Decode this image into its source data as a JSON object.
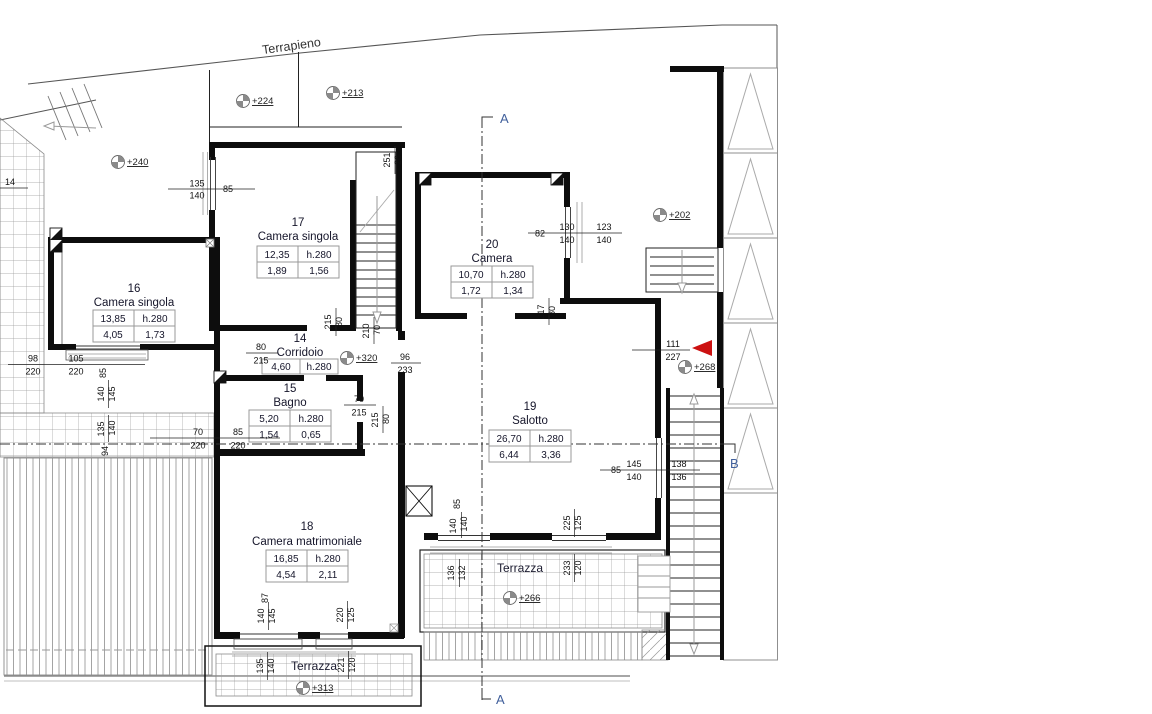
{
  "labels": {
    "terrapieno": "Terrapieno"
  },
  "rooms": {
    "r16": {
      "num": "16",
      "name": "Camera singola",
      "area": "13,85",
      "h": "h.280",
      "v1": "4,05",
      "v2": "1,73"
    },
    "r17": {
      "num": "17",
      "name": "Camera singola",
      "area": "12,35",
      "h": "h.280",
      "v1": "1,89",
      "v2": "1,56"
    },
    "r14": {
      "num": "14",
      "name": "Corridoio",
      "area": "4,60",
      "h": "h.280"
    },
    "r15": {
      "num": "15",
      "name": "Bagno",
      "area": "5,20",
      "h": "h.280",
      "v1": "1,54",
      "v2": "0,65"
    },
    "r18": {
      "num": "18",
      "name": "Camera matrimoniale",
      "area": "16,85",
      "h": "h.280",
      "v1": "4,54",
      "v2": "2,11"
    },
    "r19": {
      "num": "19",
      "name": "Salotto",
      "area": "26,70",
      "h": "h.280",
      "v1": "6,44",
      "v2": "3,36"
    },
    "r20": {
      "num": "20",
      "name": "Camera",
      "area": "10,70",
      "h": "h.280",
      "v1": "1,72",
      "v2": "1,34"
    }
  },
  "terraces": {
    "center": {
      "name": "Terrazza",
      "spot": "+266"
    },
    "south": {
      "name": "Terrazza",
      "spot": "+313"
    }
  },
  "spots": {
    "s224": "+224",
    "s213": "+213",
    "s240": "+240",
    "s202": "+202",
    "s320": "+320",
    "s268": "+268"
  },
  "sections": {
    "a_top": "A",
    "a_bottom": "A",
    "b": "B"
  },
  "dims": {
    "e14": "14",
    "a135": "135",
    "a140": "140",
    "a85": "85",
    "b98": "98",
    "b220a": "220",
    "b105": "105",
    "b220b": "220",
    "c70": "70",
    "c220a": "220",
    "c85": "85",
    "c220b": "220",
    "d80": "80",
    "d215": "215",
    "e70": "70",
    "e215": "215",
    "f215": "215",
    "f80": "80",
    "g210": "210",
    "g70": "70",
    "h251": "251",
    "h26": "26",
    "i215": "215",
    "i80": "80",
    "j82": "82",
    "j130": "130",
    "j140": "140",
    "j123": "123",
    "j140b": "140",
    "k217": "217",
    "k80": "80",
    "m96": "96",
    "m233": "233",
    "n111": "111",
    "n227": "227",
    "p85": "85",
    "p145": "145",
    "p140": "140",
    "p138": "138",
    "p136": "136",
    "q85": "85",
    "q140a": "140",
    "q140b": "140",
    "q132": "132",
    "q136": "136",
    "q225": "225",
    "q125": "125",
    "q233": "233",
    "q120": "120",
    "r16a": "85",
    "r16b": "140",
    "r16c": "145",
    "r16d": "135",
    "r16e": "140",
    "r16f": "94",
    "r18a": "87",
    "r18b": "140",
    "r18c": "145",
    "r18d": "135",
    "r18e": "140",
    "r18f": "220",
    "r18g": "125",
    "r18h": "221",
    "r18i": "120"
  },
  "colors": {
    "accent_red": "#cc1111",
    "section_blue": "#41609c",
    "hatch_gray": "#999999"
  }
}
